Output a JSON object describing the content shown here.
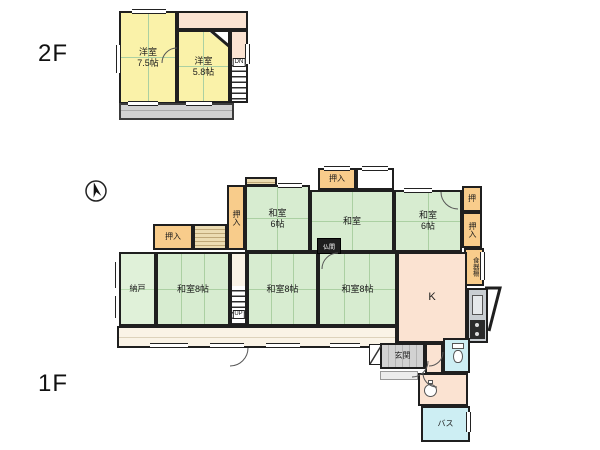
{
  "floor2": {
    "label": "2F",
    "room_a": {
      "name": "洋室",
      "size": "7.5帖"
    },
    "room_b": {
      "name": "洋室",
      "size": "5.8帖"
    },
    "stairs_label": "DN"
  },
  "floor1": {
    "label": "1F",
    "nando": "納戸",
    "washitsu8_a": "和室8帖",
    "washitsu8_b": "和室8帖",
    "washitsu8_c": "和室8帖",
    "washitsu6_a": {
      "name": "和室",
      "size": "6帖"
    },
    "washitsu_mid": "和室",
    "washitsu6_b": {
      "name": "和室",
      "size": "6帖"
    },
    "kitchen": "K",
    "genkan": "玄関",
    "bath": "バス",
    "butsuma": "仏間",
    "stairs_label": "UP",
    "oshiire_top_left": "押入",
    "oshiire_left_vert": "押入",
    "oshiire_top_mid": "押入",
    "oshi_right": "押",
    "oshiire_right_vert": "押入",
    "shokkidana": "食器棚"
  },
  "colors": {
    "wall": "#1f1f1f",
    "tatami_green": "#d7ecd0",
    "western_yellow": "#faf2a9",
    "closet_orange": "#f8cc8b",
    "hall_peach": "#fbe3d2",
    "water_cyan": "#cdeef3",
    "tile_gray": "#d2d2d2",
    "engawa_cream": "#faf3e6"
  }
}
